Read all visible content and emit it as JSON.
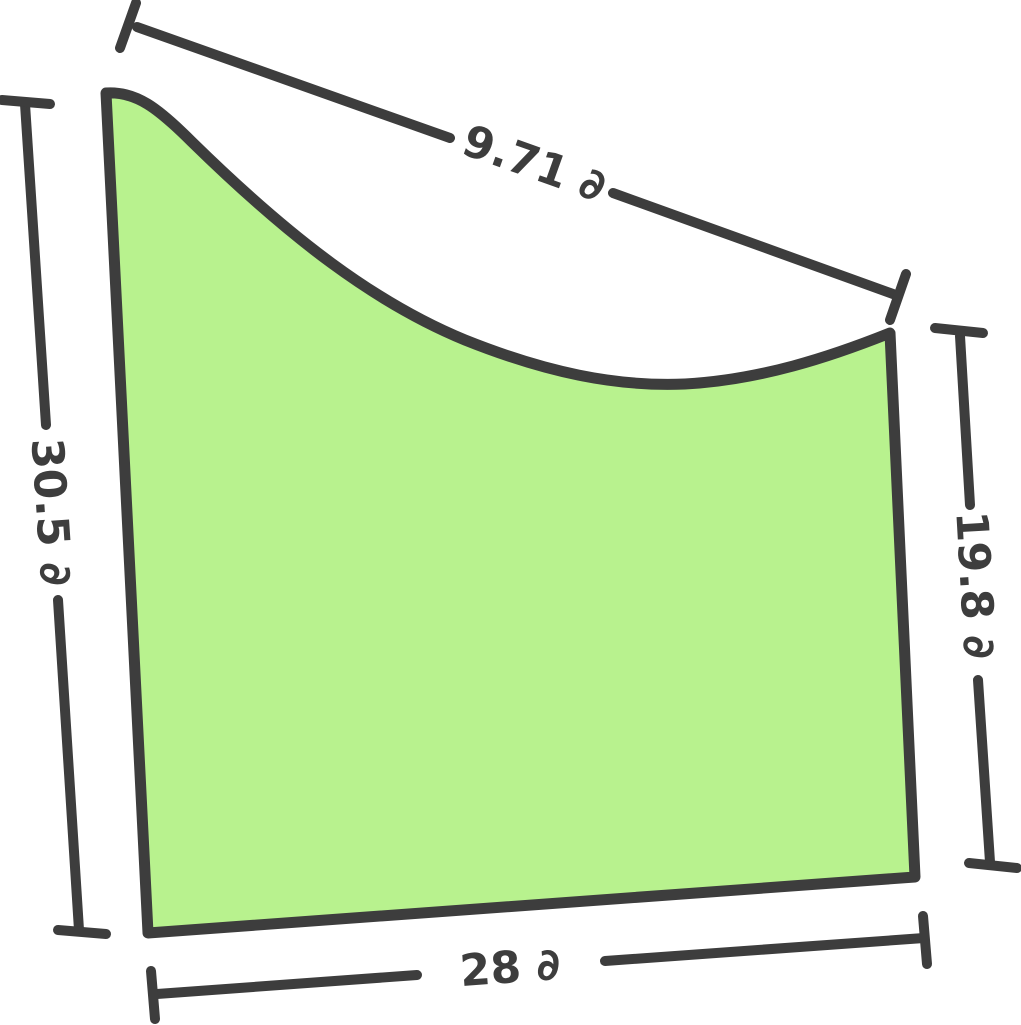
{
  "diagram": {
    "type": "geometry-figure",
    "description": "Irregular four-sided region with a concave curved top edge, annotated with dimension lines",
    "unit_symbol": "∂",
    "colors": {
      "background": "#ffffff",
      "region_fill": "#b8f28e",
      "outline": "#3d3d3d",
      "label_text": "#3d3d3d"
    },
    "measurements": {
      "top": {
        "value": 9.71,
        "unit": "∂",
        "label": "9.71 ∂",
        "side": "curved top edge"
      },
      "left": {
        "value": 30.5,
        "unit": "∂",
        "label": "30.5 ∂",
        "side": "left edge"
      },
      "right": {
        "value": 19.8,
        "unit": "∂",
        "label": "19.8 ∂",
        "side": "right edge"
      },
      "bottom": {
        "value": 28,
        "unit": "∂",
        "label": "28 ∂",
        "side": "bottom edge"
      }
    }
  }
}
